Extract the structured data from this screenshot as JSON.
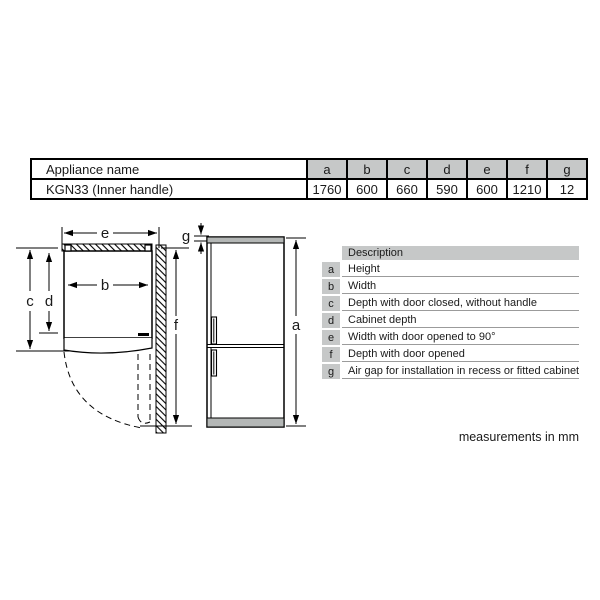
{
  "dimension_table": {
    "header_label": "Appliance name",
    "columns": [
      "a",
      "b",
      "c",
      "d",
      "e",
      "f",
      "g"
    ],
    "row": {
      "name": "KGN33 (Inner handle)",
      "values": [
        "1760",
        "600",
        "660",
        "590",
        "600",
        "1210",
        "12"
      ]
    }
  },
  "description_table": {
    "header": "Description",
    "rows": [
      {
        "key": "a",
        "desc": "Height"
      },
      {
        "key": "b",
        "desc": "Width"
      },
      {
        "key": "c",
        "desc": "Depth with door closed, without handle"
      },
      {
        "key": "d",
        "desc": "Cabinet depth"
      },
      {
        "key": "e",
        "desc": "Width with door opened to 90°"
      },
      {
        "key": "f",
        "desc": "Depth with door opened"
      },
      {
        "key": "g",
        "desc": "Air gap for installation in recess or fitted cabinet"
      }
    ]
  },
  "diagram": {
    "labels": {
      "a": "a",
      "b": "b",
      "c": "c",
      "d": "d",
      "e": "e",
      "f": "f",
      "g": "g"
    }
  },
  "page": {
    "footnote": "measurements in mm"
  },
  "colors": {
    "table_header_bg": "#c6c8c8",
    "appliance_trim": "#b4b7b6",
    "line": "#000000"
  }
}
